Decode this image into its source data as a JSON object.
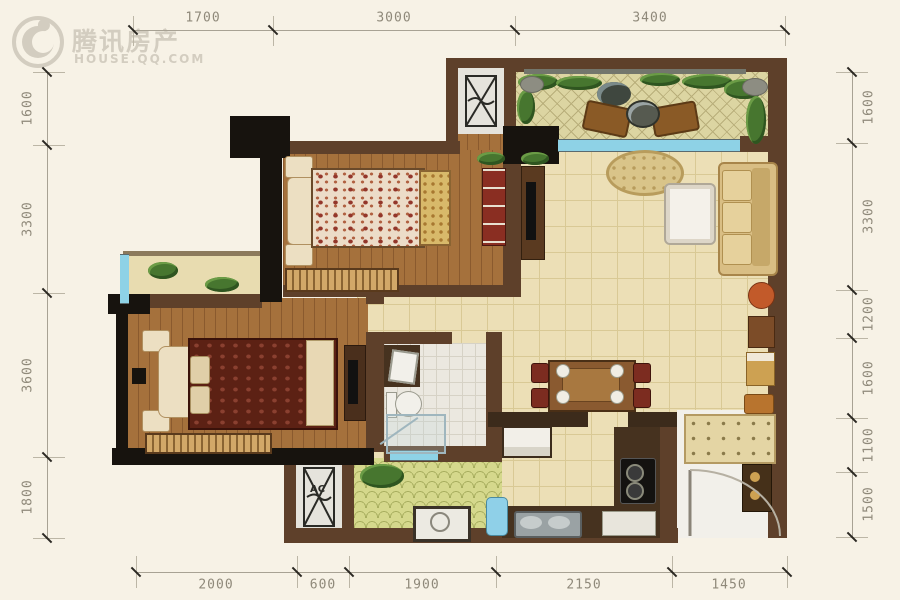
{
  "watermark": {
    "brand": "腾讯房产",
    "site": "HOUSE.QQ.COM"
  },
  "dimensions": {
    "top": [
      "1700",
      "3000",
      "3400"
    ],
    "bottom": [
      "2000",
      "600",
      "1900",
      "2150",
      "1450"
    ],
    "left": [
      "1600",
      "3300",
      "3600",
      "1800"
    ],
    "right": [
      "1600",
      "3300",
      "1200",
      "1600",
      "1100",
      "1500"
    ]
  },
  "labels": {
    "ac": "AC"
  },
  "colors": {
    "background": "#f7f2e6",
    "wall_brown": "#5e402a",
    "wall_black": "#17130e",
    "wood_floor": "#a5713c",
    "tile_floor": "#ecdfb6",
    "terrace_floor": "#dcd5a2",
    "window_blue": "#8ed2e6",
    "plant_green": "#47762f",
    "dimension_text": "#8f897a",
    "watermark_gray": "#d3cdc0"
  }
}
